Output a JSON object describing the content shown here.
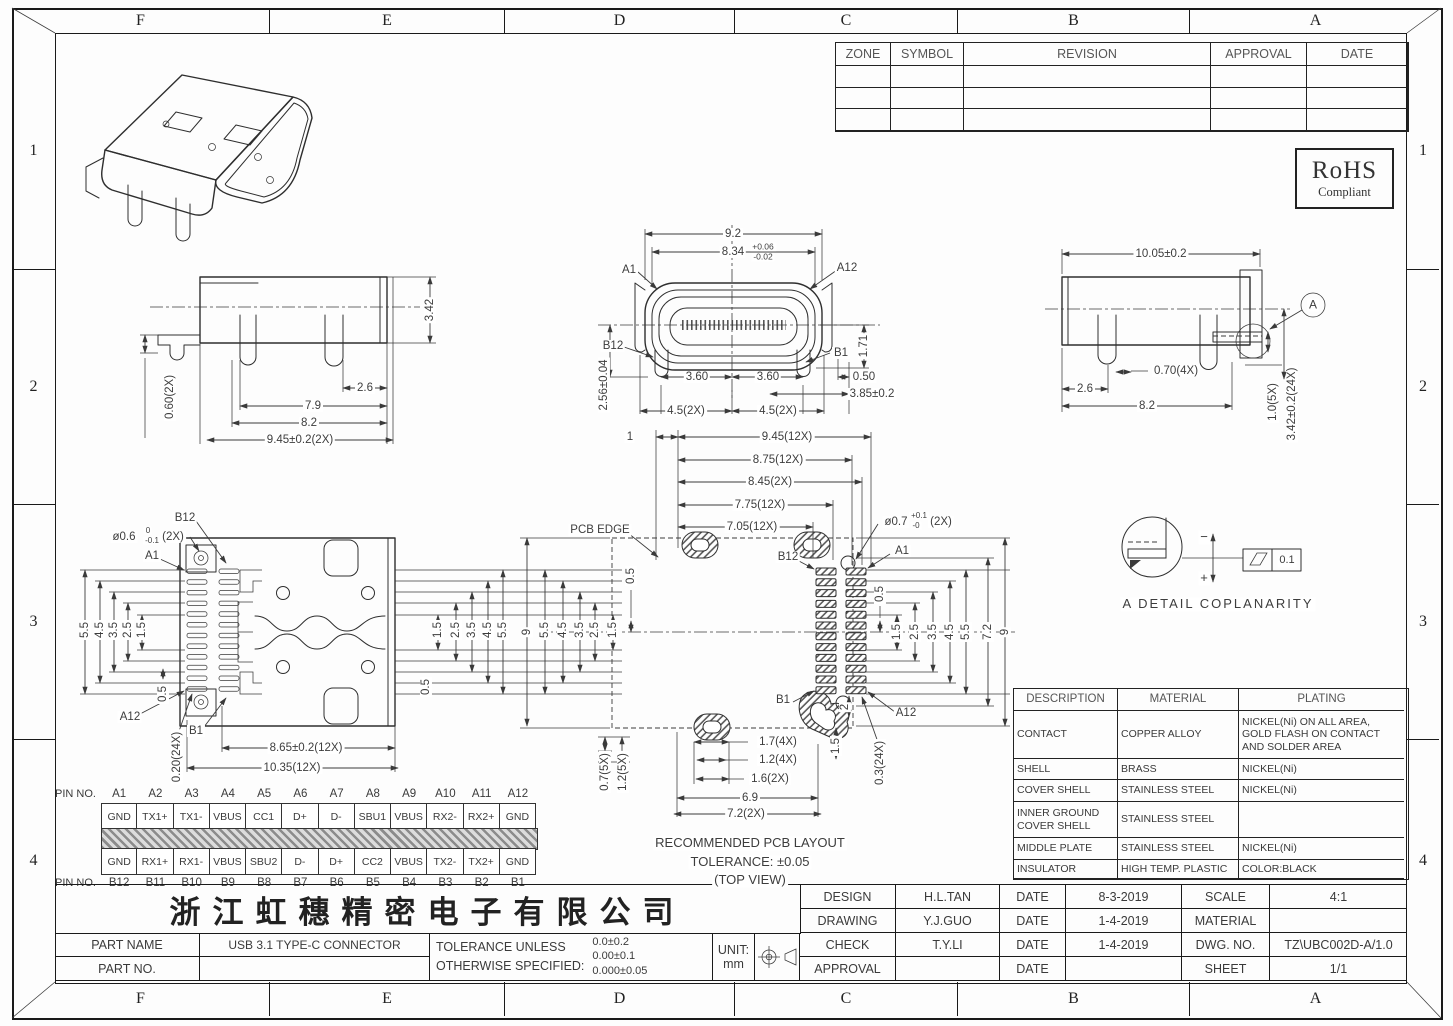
{
  "drawing": {
    "grid_letters": [
      "F",
      "E",
      "D",
      "C",
      "B",
      "A"
    ],
    "grid_numbers": [
      "1",
      "2",
      "3",
      "4"
    ]
  },
  "revision_table": {
    "headers": [
      "ZONE",
      "SYMBOL",
      "REVISION",
      "APPROVAL",
      "DATE"
    ],
    "empty_rows": 3
  },
  "rohs": {
    "line1": "RoHS",
    "line2": "Compliant"
  },
  "pin_table": {
    "row_label": "PIN NO.",
    "top_pins": [
      "A1",
      "A2",
      "A3",
      "A4",
      "A5",
      "A6",
      "A7",
      "A8",
      "A9",
      "A10",
      "A11",
      "A12"
    ],
    "top_signals": [
      "GND",
      "TX1+",
      "TX1-",
      "VBUS",
      "CC1",
      "D+",
      "D-",
      "SBU1",
      "VBUS",
      "RX2-",
      "RX2+",
      "GND"
    ],
    "bottom_signals": [
      "GND",
      "RX1+",
      "RX1-",
      "VBUS",
      "SBU2",
      "D-",
      "D+",
      "CC2",
      "VBUS",
      "TX2-",
      "TX2+",
      "GND"
    ],
    "bottom_pins": [
      "B12",
      "B11",
      "B10",
      "B9",
      "B8",
      "B7",
      "B6",
      "B5",
      "B4",
      "B3",
      "B2",
      "B1"
    ]
  },
  "materials_table": {
    "headers": [
      "DESCRIPTION",
      "MATERIAL",
      "PLATING"
    ],
    "rows": [
      [
        "CONTACT",
        "COPPER ALLOY",
        "NICKEL(Ni) ON ALL AREA,\nGOLD FLASH ON CONTACT\nAND SOLDER AREA"
      ],
      [
        "SHELL",
        "BRASS",
        "NICKEL(Ni)"
      ],
      [
        "COVER SHELL",
        "STAINLESS STEEL",
        "NICKEL(Ni)"
      ],
      [
        "INNER GROUND\nCOVER SHELL",
        "STAINLESS STEEL",
        ""
      ],
      [
        "MIDDLE PLATE",
        "STAINLESS STEEL",
        "NICKEL(Ni)"
      ],
      [
        "INSULATOR",
        "HIGH TEMP. PLASTIC",
        "COLOR:BLACK"
      ]
    ],
    "row_heights": [
      22,
      48,
      21,
      22,
      36,
      22,
      19
    ]
  },
  "title_block": {
    "company": "浙江虹穗精密电子有限公司",
    "part_name_label": "PART NAME",
    "part_name": "USB 3.1 TYPE-C CONNECTOR",
    "part_no_label": "PART NO.",
    "part_no": "",
    "tolerance_label_1": "TOLERANCE UNLESS",
    "tolerance_label_2": "OTHERWISE SPECIFIED:",
    "tolerances": [
      "0.0±0.2",
      "0.00±0.1",
      "0.000±0.05"
    ],
    "unit_label": "UNIT:",
    "unit": "mm",
    "rows": [
      [
        "DESIGN",
        "H.L.TAN",
        "DATE",
        "8-3-2019",
        "SCALE",
        "4:1"
      ],
      [
        "DRAWING",
        "Y.J.GUO",
        "DATE",
        "1-4-2019",
        "MATERIAL",
        ""
      ],
      [
        "CHECK",
        "T.Y.LI",
        "DATE",
        "1-4-2019",
        "DWG. NO.",
        "TZ\\UBC002D-A/1.0"
      ],
      [
        "APPROVAL",
        "",
        "DATE",
        "",
        "SHEET",
        "1/1"
      ]
    ]
  },
  "dims": [
    {
      "t": "3.42",
      "x": 430,
      "y": 310,
      "r": -90
    },
    {
      "t": "0.60(2X)",
      "x": 170,
      "y": 397,
      "r": -90
    },
    {
      "t": "2.6",
      "x": 365,
      "y": 388
    },
    {
      "t": "7.9",
      "x": 313,
      "y": 406
    },
    {
      "t": "8.2",
      "x": 309,
      "y": 423
    },
    {
      "t": "9.45±0.2(2X)",
      "x": 300,
      "y": 440
    },
    {
      "t": "9.2",
      "x": 733,
      "y": 234
    },
    {
      "t": "8.34",
      "x": 733,
      "y": 252
    },
    {
      "t": "+0.06",
      "x": 763,
      "y": 247,
      "s": 8.5
    },
    {
      "t": "-0.02",
      "x": 763,
      "y": 257,
      "s": 8.5
    },
    {
      "t": "A1",
      "x": 629,
      "y": 270
    },
    {
      "t": "A12",
      "x": 847,
      "y": 268
    },
    {
      "t": "B12",
      "x": 613,
      "y": 346
    },
    {
      "t": "B1",
      "x": 841,
      "y": 353
    },
    {
      "t": "1.71",
      "x": 864,
      "y": 346,
      "r": -90
    },
    {
      "t": "2.56±0.04",
      "x": 604,
      "y": 385,
      "r": -90
    },
    {
      "t": "3.60",
      "x": 697,
      "y": 377
    },
    {
      "t": "3.60",
      "x": 768,
      "y": 377
    },
    {
      "t": "0.50",
      "x": 864,
      "y": 377
    },
    {
      "t": "3.85±0.2",
      "x": 872,
      "y": 394
    },
    {
      "t": "4.5(2X)",
      "x": 686,
      "y": 411
    },
    {
      "t": "4.5(2X)",
      "x": 778,
      "y": 411
    },
    {
      "t": "10.05±0.2",
      "x": 1161,
      "y": 254
    },
    {
      "t": "A",
      "x": 1313,
      "y": 305,
      "s": 12
    },
    {
      "t": "0.70(4X)",
      "x": 1176,
      "y": 371
    },
    {
      "t": "2.6",
      "x": 1085,
      "y": 389
    },
    {
      "t": "8.2",
      "x": 1147,
      "y": 406
    },
    {
      "t": "1.0(5X)",
      "x": 1273,
      "y": 402,
      "r": -90
    },
    {
      "t": "3.42±0.2(24X)",
      "x": 1292,
      "y": 404,
      "r": -90
    },
    {
      "t": "B12",
      "x": 185,
      "y": 518
    },
    {
      "t": "ø0.6",
      "x": 124,
      "y": 537
    },
    {
      "t": "0",
      "x": 148,
      "y": 531,
      "s": 8
    },
    {
      "t": "-0.1",
      "x": 152,
      "y": 541,
      "s": 8
    },
    {
      "t": "(2X)",
      "x": 173,
      "y": 537
    },
    {
      "t": "A1",
      "x": 152,
      "y": 556
    },
    {
      "t": "5.5",
      "x": 85,
      "y": 630,
      "r": -90
    },
    {
      "t": "4.5",
      "x": 100,
      "y": 630,
      "r": -90
    },
    {
      "t": "3.5",
      "x": 114,
      "y": 630,
      "r": -90
    },
    {
      "t": "2.5",
      "x": 128,
      "y": 630,
      "r": -90
    },
    {
      "t": "1.5",
      "x": 142,
      "y": 630,
      "r": -90
    },
    {
      "t": "0.5",
      "x": 163,
      "y": 694,
      "r": -90
    },
    {
      "t": "A12",
      "x": 130,
      "y": 717
    },
    {
      "t": "B1",
      "x": 196,
      "y": 731
    },
    {
      "t": "0.20(24X)",
      "x": 177,
      "y": 757,
      "r": -90
    },
    {
      "t": "8.65±0.2(12X)",
      "x": 306,
      "y": 748
    },
    {
      "t": "10.35(12X)",
      "x": 292,
      "y": 768
    },
    {
      "t": "1.5",
      "x": 438,
      "y": 630,
      "r": -90
    },
    {
      "t": "2.5",
      "x": 456,
      "y": 630,
      "r": -90
    },
    {
      "t": "3.5",
      "x": 472,
      "y": 630,
      "r": -90
    },
    {
      "t": "4.5",
      "x": 488,
      "y": 630,
      "r": -90
    },
    {
      "t": "5.5",
      "x": 503,
      "y": 630,
      "r": -90
    },
    {
      "t": "0.5",
      "x": 426,
      "y": 687,
      "r": -90
    },
    {
      "t": "1",
      "x": 630,
      "y": 437
    },
    {
      "t": "9.45(12X)",
      "x": 787,
      "y": 437
    },
    {
      "t": "8.75(12X)",
      "x": 778,
      "y": 460
    },
    {
      "t": "8.45(2X)",
      "x": 770,
      "y": 482
    },
    {
      "t": "7.75(12X)",
      "x": 760,
      "y": 505
    },
    {
      "t": "7.05(12X)",
      "x": 752,
      "y": 527
    },
    {
      "t": "PCB EDGE",
      "x": 600,
      "y": 530
    },
    {
      "t": "ø0.7",
      "x": 896,
      "y": 522
    },
    {
      "t": "+0.1",
      "x": 919,
      "y": 516,
      "s": 8
    },
    {
      "t": "-0",
      "x": 916,
      "y": 526,
      "s": 8
    },
    {
      "t": "(2X)",
      "x": 941,
      "y": 522
    },
    {
      "t": "B12",
      "x": 788,
      "y": 557
    },
    {
      "t": "A1",
      "x": 902,
      "y": 551
    },
    {
      "t": "9",
      "x": 527,
      "y": 632,
      "r": -90
    },
    {
      "t": "5.5",
      "x": 545,
      "y": 630,
      "r": -90
    },
    {
      "t": "4.5",
      "x": 563,
      "y": 630,
      "r": -90
    },
    {
      "t": "3.5",
      "x": 580,
      "y": 630,
      "r": -90
    },
    {
      "t": "2.5",
      "x": 595,
      "y": 630,
      "r": -90
    },
    {
      "t": "1.5",
      "x": 613,
      "y": 630,
      "r": -90
    },
    {
      "t": "0.5",
      "x": 631,
      "y": 576,
      "r": -90
    },
    {
      "t": "0.5",
      "x": 880,
      "y": 594,
      "r": -90
    },
    {
      "t": "1.5",
      "x": 897,
      "y": 632,
      "r": -90
    },
    {
      "t": "2.5",
      "x": 915,
      "y": 632,
      "r": -90
    },
    {
      "t": "3.5",
      "x": 933,
      "y": 632,
      "r": -90
    },
    {
      "t": "4.5",
      "x": 950,
      "y": 632,
      "r": -90
    },
    {
      "t": "5.5",
      "x": 966,
      "y": 632,
      "r": -90
    },
    {
      "t": "7.2",
      "x": 988,
      "y": 632,
      "r": -90
    },
    {
      "t": "9",
      "x": 1005,
      "y": 632,
      "r": -90
    },
    {
      "t": "B1",
      "x": 783,
      "y": 700
    },
    {
      "t": "A12",
      "x": 906,
      "y": 713
    },
    {
      "t": "2",
      "x": 845,
      "y": 707,
      "r": -90
    },
    {
      "t": "1.5",
      "x": 836,
      "y": 746,
      "r": -90
    },
    {
      "t": "0.3(24X)",
      "x": 880,
      "y": 763,
      "r": -90
    },
    {
      "t": "1.7(4X)",
      "x": 778,
      "y": 742
    },
    {
      "t": "1.2(4X)",
      "x": 778,
      "y": 760
    },
    {
      "t": "1.6(2X)",
      "x": 770,
      "y": 779
    },
    {
      "t": "6.9",
      "x": 750,
      "y": 798
    },
    {
      "t": "7.2(2X)",
      "x": 746,
      "y": 814
    },
    {
      "t": "0.7(5X)",
      "x": 605,
      "y": 772,
      "r": -90
    },
    {
      "t": "1.2(5X)",
      "x": 623,
      "y": 772,
      "r": -90
    },
    {
      "t": "RECOMMENDED PCB LAYOUT",
      "x": 750,
      "y": 843,
      "s": 13
    },
    {
      "t": "TOLERANCE: ±0.05",
      "x": 750,
      "y": 862,
      "s": 13
    },
    {
      "t": "(TOP VIEW)",
      "x": 750,
      "y": 880,
      "s": 13
    },
    {
      "t": "−",
      "x": 1204,
      "y": 537,
      "s": 13
    },
    {
      "t": "+",
      "x": 1204,
      "y": 578,
      "s": 13
    },
    {
      "t": "0.1",
      "x": 1287,
      "y": 561,
      "s": 11
    },
    {
      "t": "A DETAIL COPLANARITY",
      "x": 1218,
      "y": 604,
      "s": 13,
      "sp": 2
    }
  ]
}
